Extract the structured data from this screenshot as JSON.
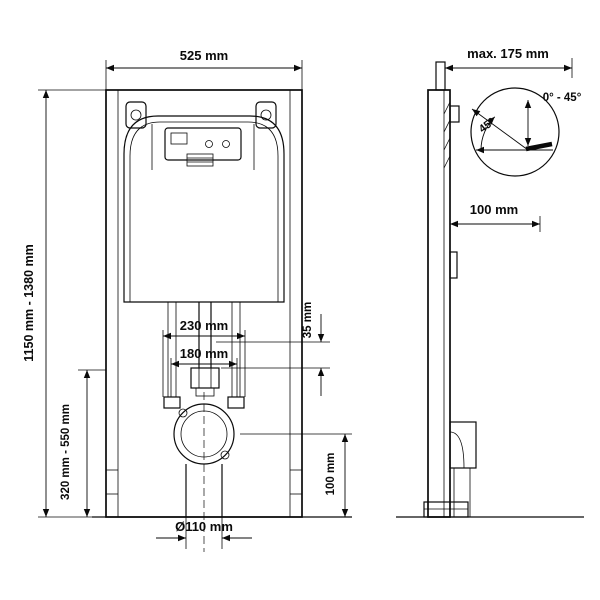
{
  "front_view": {
    "width_label": "525 mm",
    "height_range_label": "1150 mm - 1380 mm",
    "outlet_height_range_label": "320 mm - 550 mm",
    "stud_spacing_outer_label": "230 mm",
    "stud_spacing_inner_label": "180 mm",
    "offset_label": "35 mm",
    "drain_height_label": "100 mm",
    "drain_pipe_diameter_label": "Ø110 mm"
  },
  "side_view": {
    "max_depth_label": "max. 175 mm",
    "wall_distance_label": "100 mm"
  },
  "angle_detail": {
    "angle_label": "45°",
    "angle_range_label": "0° - 45°"
  }
}
